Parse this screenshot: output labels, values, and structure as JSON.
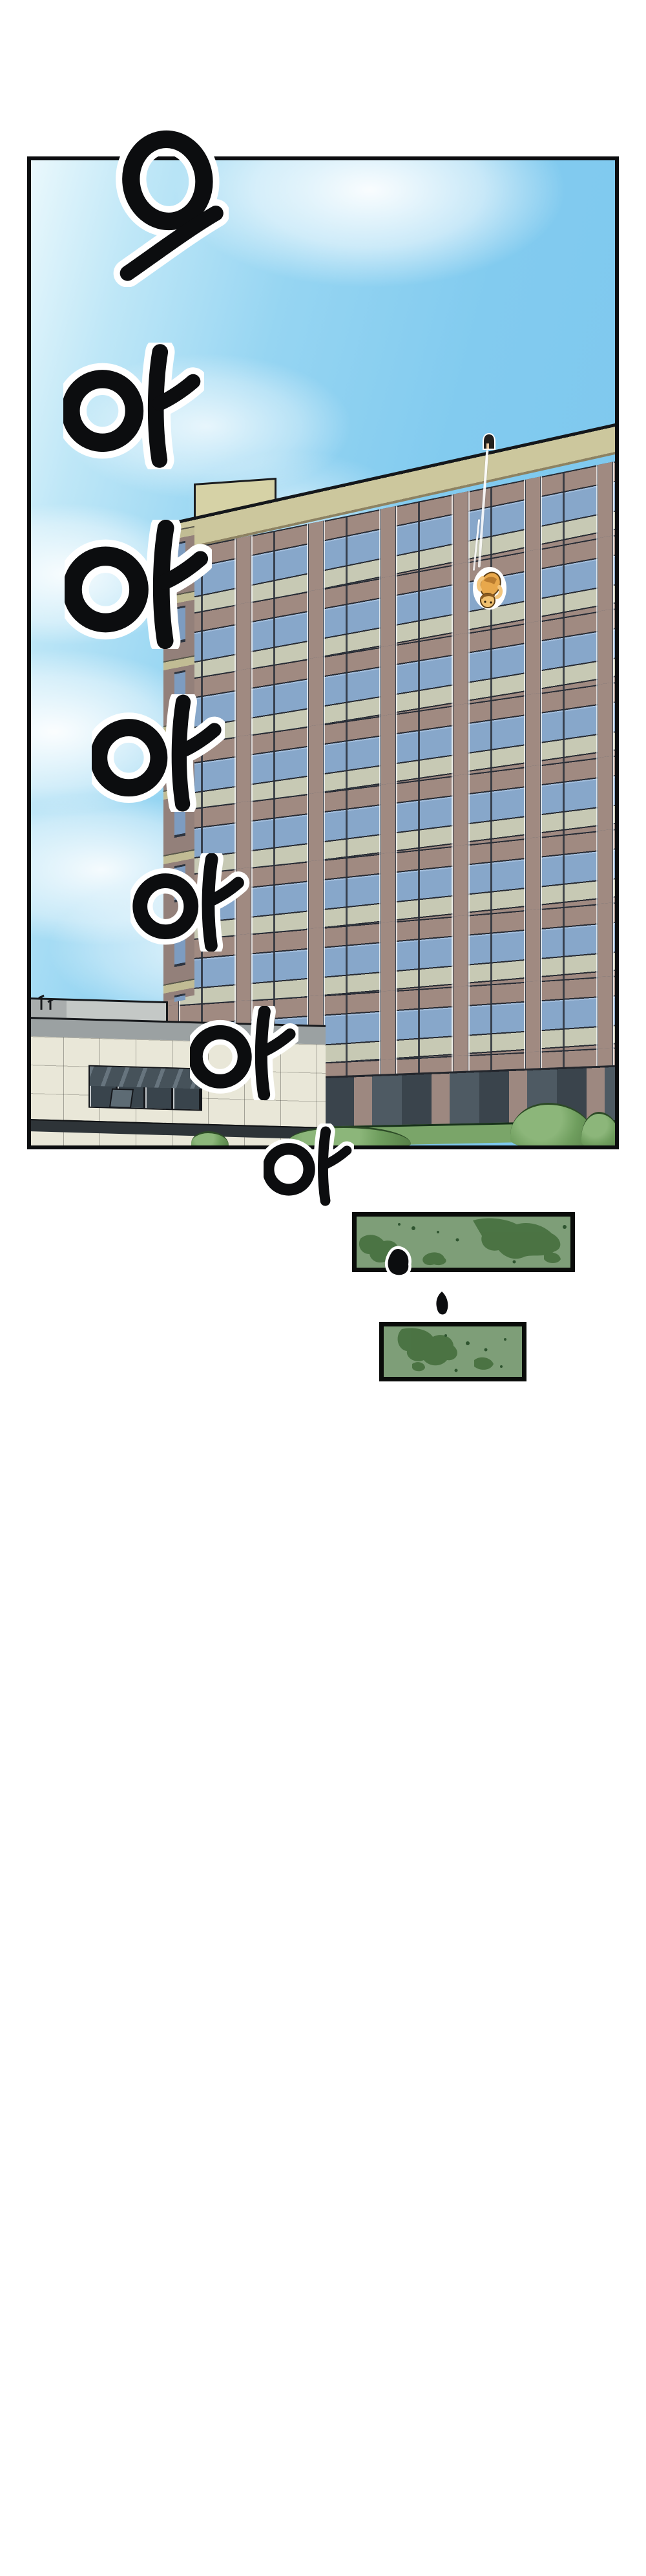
{
  "scene": {
    "panel_aria": "comic panel: person falling from the roof of a tall office building into the sky",
    "faller_aria": "small falling figure",
    "observer_aria": "person peeking over the rooftop edge",
    "hedge1_aria": "green hedge texture block",
    "hedge2_aria": "green hedge texture block",
    "drop1_aria": "ink droplet",
    "drop2_aria": "ink droplet"
  },
  "scream": {
    "full_text": "으아아아아아아",
    "syllables": [
      {
        "char": "으"
      },
      {
        "char": "아"
      },
      {
        "char": "아"
      },
      {
        "char": "아"
      },
      {
        "char": "아"
      },
      {
        "char": "아"
      },
      {
        "char": "아"
      }
    ]
  },
  "colors": {
    "sky_top": "#eaf8fc",
    "sky_main": "#7cc6ee",
    "cloud": "#ffffff",
    "facade_mauve": "#a08a81",
    "roof_band_khaki": "#ccc79d",
    "window_glass": "#87a7ca",
    "spandrel_sage": "#c7c9b4",
    "low_building_cream": "#e9e7d8",
    "parapet_gray": "#9ba1a2",
    "hedge_green": "#7e9e78",
    "hedge_dark_green": "#466f3e",
    "ink_black": "#0c0d0f",
    "faller_orange": "#e8a84c"
  }
}
